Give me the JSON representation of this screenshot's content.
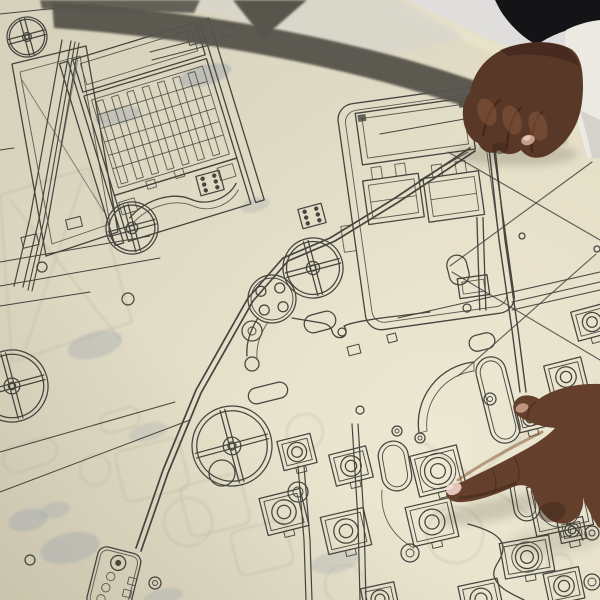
{
  "scene": {
    "type": "photograph",
    "description": "Two hands over a large cream-colored engineering blueprint spread on a table: a fist with black and white sleeves rests on the sheet at top right, while another hand points with its index finger at a drawn bearing-mount component near the bottom center.",
    "sheet": "large technical line drawing with a dark band along its folded top edge",
    "resting_hand": "closed fist, knuckles down, top right",
    "pointing_hand": "index finger extended, touching the sheet, bottom right",
    "pointed_element": "square bearing-mount with concentric rings"
  },
  "palette": {
    "bg": "#d2d2d0",
    "bg_bright": "#dfdedc",
    "paper": "#e2dcc4",
    "paper_bright": "#ece6cc",
    "paper_fold": "#d9d6cc",
    "ink": "#45443e",
    "ink_soft": "#6b6a62",
    "ghost": "#a2a8b0",
    "ghost_warm": "#b5b09c",
    "stripe": "#57544c",
    "stripe_soft": "#6e6b63",
    "sleeve_black": "#141416",
    "sleeve_white": "#ece9e2",
    "sleeve_white_shadow": "#cfccc5",
    "skin1": "#5a3828",
    "skin2": "#64402c",
    "skin_dark": "#3a231a",
    "skin_light": "#8a5a3d",
    "nail": "#e3c4b8",
    "nail_soft": "#c79e8b"
  },
  "blueprint": {
    "wheels": [
      [
        27,
        37,
        20
      ],
      [
        132,
        228,
        26
      ],
      [
        313,
        268,
        30
      ],
      [
        232,
        446,
        40
      ],
      [
        12,
        386,
        36
      ]
    ],
    "flange": {
      "cx": 272,
      "cy": 299,
      "r": 24,
      "hole_r": 5,
      "hole_radius": 13.5,
      "hole_angles": [
        35,
        125,
        215,
        305
      ]
    },
    "mounts": [
      [
        297,
        452,
        34,
        30,
        -14,
        1
      ],
      [
        351,
        466,
        38,
        32,
        -14,
        1
      ],
      [
        284,
        512,
        42,
        38,
        -14,
        1
      ],
      [
        346,
        531,
        44,
        38,
        -13,
        1
      ],
      [
        432,
        522,
        46,
        40,
        -13,
        1
      ],
      [
        560,
        506,
        58,
        50,
        -12,
        2
      ],
      [
        566,
        377,
        38,
        32,
        -14,
        1
      ],
      [
        592,
        322,
        36,
        30,
        -15,
        1
      ],
      [
        438,
        471,
        48,
        42,
        -14,
        2
      ],
      [
        527,
        557,
        50,
        36,
        -10,
        2
      ],
      [
        572,
        530,
        26,
        22,
        -12,
        1
      ],
      [
        564,
        586,
        36,
        32,
        -12,
        1
      ],
      [
        481,
        599,
        40,
        34,
        -12,
        1
      ],
      [
        380,
        599,
        34,
        28,
        -12,
        1
      ],
      [
        530,
        419,
        26,
        22,
        -14,
        1
      ],
      [
        597,
        452,
        36,
        30,
        -13,
        1
      ]
    ],
    "circles": [
      [
        222,
        473,
        13,
        0
      ],
      [
        252,
        331,
        10,
        4
      ],
      [
        397,
        431,
        5,
        2
      ],
      [
        420,
        438,
        5,
        2
      ],
      [
        490,
        399,
        6,
        2.5
      ],
      [
        128,
        299,
        6,
        0
      ],
      [
        42,
        267,
        5,
        0
      ],
      [
        410,
        553,
        9,
        4
      ],
      [
        155,
        583,
        6,
        2.5
      ],
      [
        30,
        560,
        5,
        0
      ],
      [
        342,
        332,
        4,
        0
      ],
      [
        522,
        236,
        3,
        0
      ],
      [
        597,
        249,
        3,
        0
      ],
      [
        360,
        410,
        4,
        0
      ],
      [
        467,
        308,
        4,
        0
      ],
      [
        298,
        492,
        10,
        5
      ],
      [
        592,
        533,
        7,
        3
      ],
      [
        592,
        582,
        8,
        4
      ]
    ],
    "pills": [
      [
        395,
        466,
        30,
        50,
        -10
      ],
      [
        498,
        400,
        30,
        88,
        -14
      ],
      [
        320,
        322,
        32,
        18,
        -15
      ],
      [
        525,
        497,
        26,
        48,
        -10
      ],
      [
        458,
        270,
        20,
        30,
        -14
      ],
      [
        268,
        393,
        40,
        16,
        -14
      ],
      [
        482,
        342,
        26,
        16,
        -14
      ]
    ],
    "rails": [
      {
        "pts": [
          [
            470,
            148
          ],
          [
            392,
            200
          ],
          [
            330,
            238
          ],
          [
            283,
            258
          ],
          [
            248,
            298
          ],
          [
            196,
            390
          ],
          [
            163,
            470
          ],
          [
            136,
            548
          ]
        ],
        "off": [
          5,
          3
        ],
        "w": 1.7
      },
      {
        "pts": [
          [
            62,
            40
          ],
          [
            30,
            218
          ],
          [
            14,
            286
          ]
        ],
        "off": [
          9,
          1
        ],
        "w": 1.2
      },
      {
        "pts": [
          [
            75,
            42
          ],
          [
            44,
            220
          ],
          [
            28,
            290
          ]
        ],
        "off": [
          4,
          1
        ],
        "w": 1.1
      },
      {
        "pts": [
          [
            487,
            130
          ],
          [
            499,
            240
          ],
          [
            512,
            330
          ],
          [
            520,
            392
          ]
        ],
        "off": [
          6,
          0
        ],
        "w": 1.4
      },
      {
        "pts": [
          [
            352,
            424
          ],
          [
            358,
            520
          ],
          [
            360,
            600
          ]
        ],
        "off": [
          6,
          0
        ],
        "w": 1.2
      },
      {
        "pts": [
          [
            298,
            466
          ],
          [
            304,
            540
          ],
          [
            306,
            600
          ]
        ],
        "off": [
          6,
          0
        ],
        "w": 1.2
      }
    ],
    "lines": [
      [
        0,
        262,
        150,
        236
      ],
      [
        0,
        286,
        160,
        258
      ],
      [
        0,
        306,
        90,
        292
      ],
      [
        380,
        134,
        560,
        102
      ],
      [
        398,
        318,
        600,
        272
      ],
      [
        512,
        302,
        600,
        282
      ],
      [
        512,
        310,
        600,
        290
      ],
      [
        0,
        452,
        175,
        402
      ],
      [
        0,
        492,
        190,
        420
      ],
      [
        150,
        52,
        212,
        36
      ],
      [
        152,
        60,
        214,
        44
      ],
      [
        420,
        180,
        468,
        152
      ],
      [
        0,
        150,
        14,
        148
      ],
      [
        0,
        14,
        96,
        4
      ]
    ],
    "xbraces": [
      [
        448,
        152,
        600,
        240
      ],
      [
        592,
        162,
        450,
        266
      ],
      [
        452,
        272,
        600,
        360
      ],
      [
        596,
        254,
        458,
        376
      ]
    ],
    "rects": [
      [
        30,
        241,
        16,
        11,
        -14
      ],
      [
        74,
        223,
        15,
        10,
        -14
      ],
      [
        196,
        38,
        16,
        11,
        -16
      ],
      [
        228,
        31,
        14,
        10,
        -16
      ],
      [
        354,
        350,
        12,
        9,
        -14
      ],
      [
        392,
        338,
        9,
        8,
        -14
      ]
    ],
    "dot_blocks": [
      [
        312,
        216
      ],
      [
        210,
        183
      ]
    ],
    "ghosts": {
      "blobs": [
        [
          205,
          75,
          27,
          10,
          -15,
          0.5
        ],
        [
          118,
          116,
          23,
          8,
          -12,
          0.42
        ],
        [
          95,
          345,
          28,
          13,
          -15,
          0.38
        ],
        [
          70,
          548,
          30,
          15,
          -12,
          0.42
        ],
        [
          148,
          432,
          20,
          9,
          -14,
          0.28
        ],
        [
          335,
          562,
          25,
          11,
          -12,
          0.3
        ],
        [
          28,
          520,
          20,
          11,
          -12,
          0.42
        ],
        [
          55,
          510,
          15,
          8,
          -12,
          0.36
        ],
        [
          163,
          597,
          20,
          8,
          -12,
          0.36
        ],
        [
          255,
          205,
          15,
          7,
          -15,
          0.3
        ]
      ],
      "circles": [
        [
          188,
          522,
          24
        ],
        [
          305,
          432,
          18
        ],
        [
          345,
          585,
          20
        ],
        [
          95,
          470,
          15
        ],
        [
          455,
          535,
          28
        ],
        [
          560,
          566,
          12
        ]
      ],
      "rrects": [
        [
          215,
          505,
          62,
          52,
          -14
        ],
        [
          262,
          548,
          56,
          46,
          -14
        ],
        [
          152,
          470,
          66,
          52,
          -14
        ]
      ],
      "lines": [
        [
          10,
          200,
          120,
          340
        ],
        [
          85,
          172,
          25,
          350
        ],
        [
          420,
          440,
          545,
          525
        ],
        [
          530,
          430,
          432,
          515
        ]
      ],
      "quads": [
        [
          0,
          195,
          88,
          168,
          132,
          322,
          12,
          362
        ]
      ],
      "pills": [
        [
          30,
          455,
          55,
          26,
          -18
        ],
        [
          120,
          420,
          40,
          20,
          -16
        ]
      ]
    }
  }
}
